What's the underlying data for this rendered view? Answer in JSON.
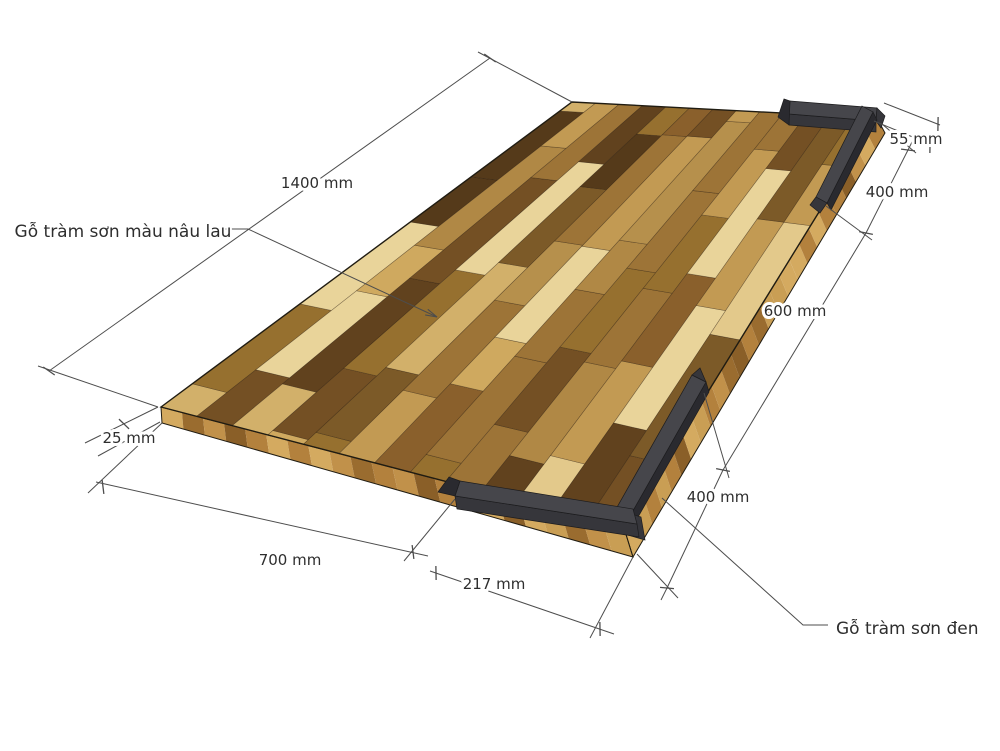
{
  "drawing": {
    "background": "#ffffff",
    "materials": {
      "top_panel_label": "Gỗ tràm sơn màu nâu lau",
      "black_rail_label": "Gỗ tràm sơn đen"
    },
    "dimensions": {
      "panel_length": "1400 mm",
      "panel_width": "700 mm",
      "panel_thickness": "25 mm",
      "rail_width": "55 mm",
      "rail_top_length": "400 mm",
      "rail_gap": "600 mm",
      "rail_bottom_length": "400 mm",
      "rail_corner_arm": "217 mm"
    },
    "colors": {
      "line": "#4d4d4d",
      "text": "#2e2e2e",
      "outline": "#201c12",
      "rail_top": "#46464b",
      "rail_front": "#36363b",
      "rail_dark": "#2a2a2f",
      "wood_palette": [
        "#e3c98b",
        "#d2b06a",
        "#c29a53",
        "#b08845",
        "#9d7437",
        "#8a602c",
        "#745024",
        "#61421e",
        "#b6904c",
        "#96702f",
        "#cfa95f",
        "#7c5a28",
        "#e9d49a",
        "#553a1a"
      ],
      "edge_palette": [
        "#c99e54",
        "#b3813d",
        "#9a6c2f",
        "#d4aa60",
        "#8a5f28",
        "#c1914a"
      ]
    }
  }
}
